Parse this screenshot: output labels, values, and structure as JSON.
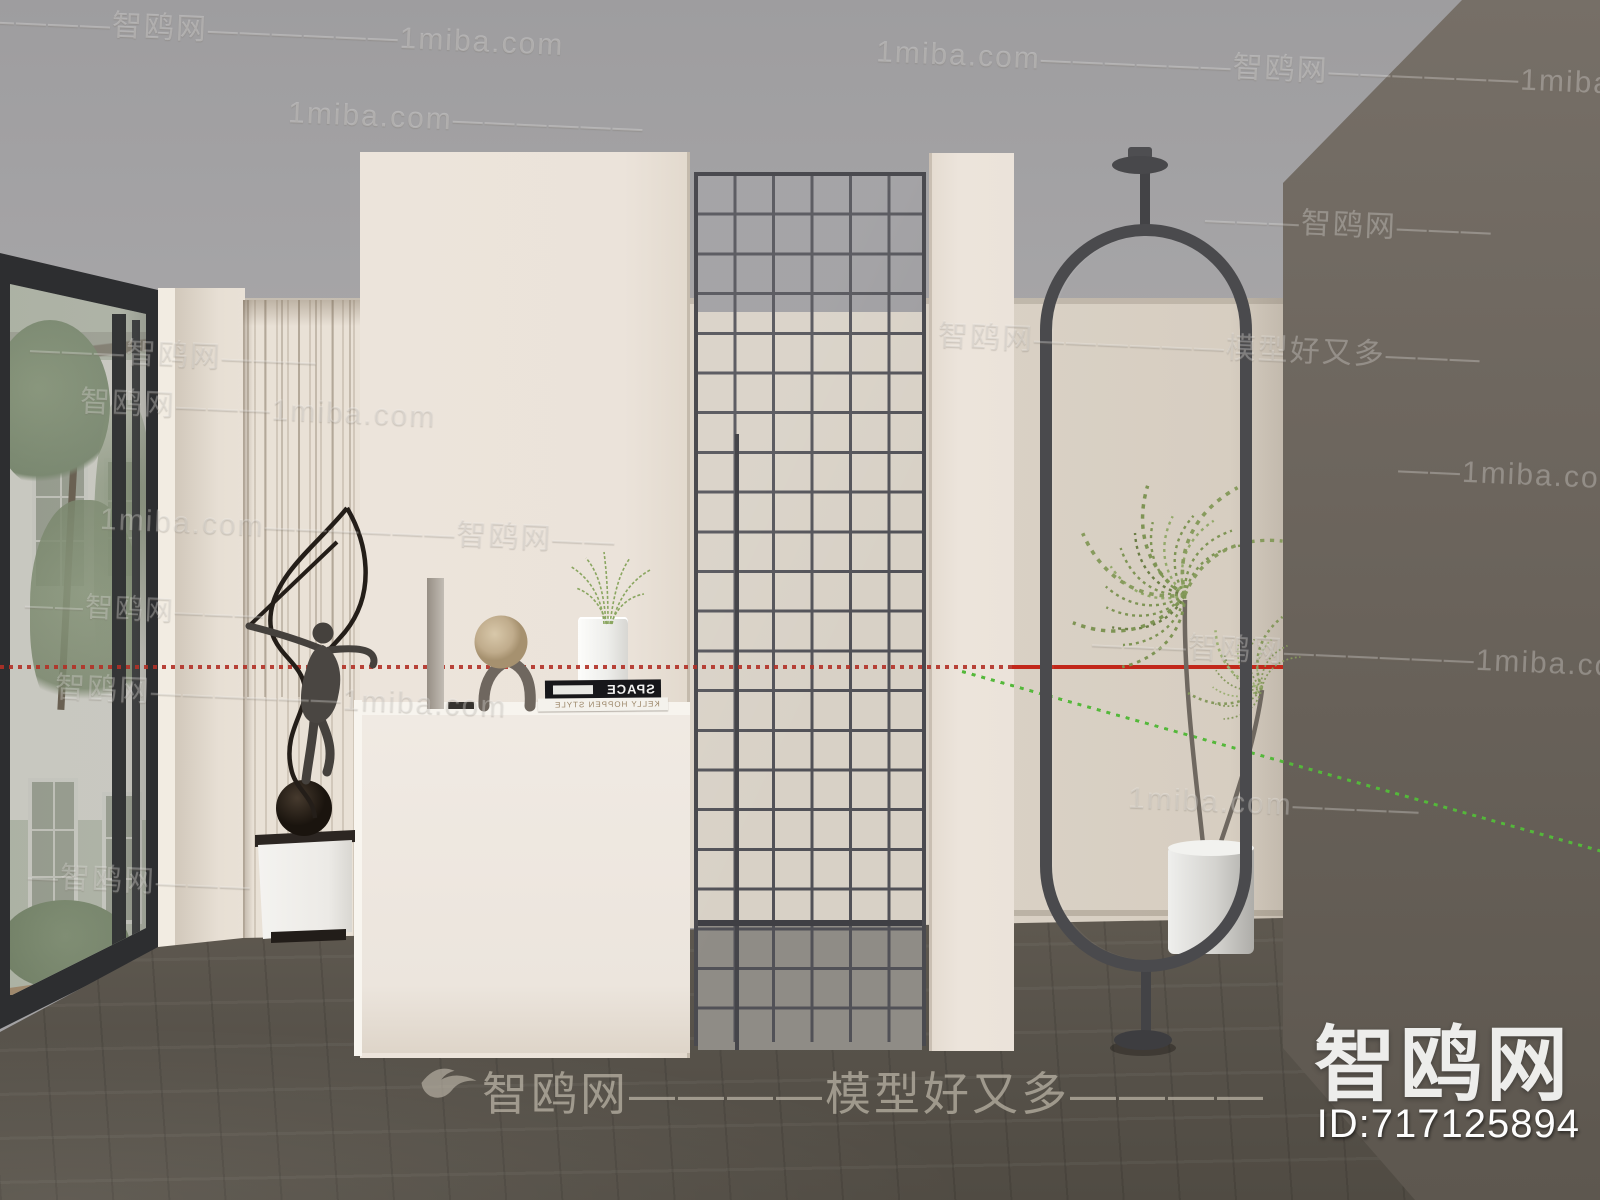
{
  "watermark": {
    "site": "1miba.com",
    "brand": "智鸥网",
    "slogan": "模型好又多",
    "items": [
      {
        "x": -80,
        "y": 6,
        "size": 30,
        "text": "——————智鸥网——————1miba.com"
      },
      {
        "x": 876,
        "y": 44,
        "size": 30,
        "text": "1miba.com——————智鸥网——————1miba.com"
      },
      {
        "x": 288,
        "y": 104,
        "size": 30,
        "text": "1miba.com——————"
      },
      {
        "x": 1205,
        "y": 200,
        "size": 30,
        "text": "———智鸥网———"
      },
      {
        "x": 30,
        "y": 330,
        "size": 30,
        "text": "———智鸥网———"
      },
      {
        "x": 938,
        "y": 322,
        "size": 30,
        "text": "智鸥网——————模型好又多———"
      },
      {
        "x": 80,
        "y": 384,
        "size": 30,
        "text": "智鸥网———1miba.com"
      },
      {
        "x": 1398,
        "y": 458,
        "size": 30,
        "text": "——1miba.com"
      },
      {
        "x": 100,
        "y": 505,
        "size": 30,
        "text": "1miba.com——————智鸥网——"
      },
      {
        "x": 25,
        "y": 588,
        "size": 28,
        "text": "——智鸥网———"
      },
      {
        "x": 1092,
        "y": 630,
        "size": 30,
        "text": "———智鸥网——————1miba.com"
      },
      {
        "x": 55,
        "y": 672,
        "size": 30,
        "text": "智鸥网——————1miba.com"
      },
      {
        "x": 1128,
        "y": 788,
        "size": 30,
        "text": "1miba.com————"
      },
      {
        "x": 28,
        "y": 856,
        "size": 30,
        "text": "—智鸥网———"
      }
    ],
    "footer_center": "智鸥网————模型好又多————",
    "brand_large": "智鸥网",
    "model_id": "ID:717125894"
  },
  "books": {
    "top_title": "SPACE",
    "bottom_title": "KELLY HOPPEN STYLE"
  },
  "colors": {
    "accent_red": "#c2271a",
    "accent_green": "#54b83a",
    "ceiling": "#a3a2a4",
    "wall_cream": "#ddd5ca",
    "wall_dark": "#6b645c",
    "floor": "#57524a"
  }
}
